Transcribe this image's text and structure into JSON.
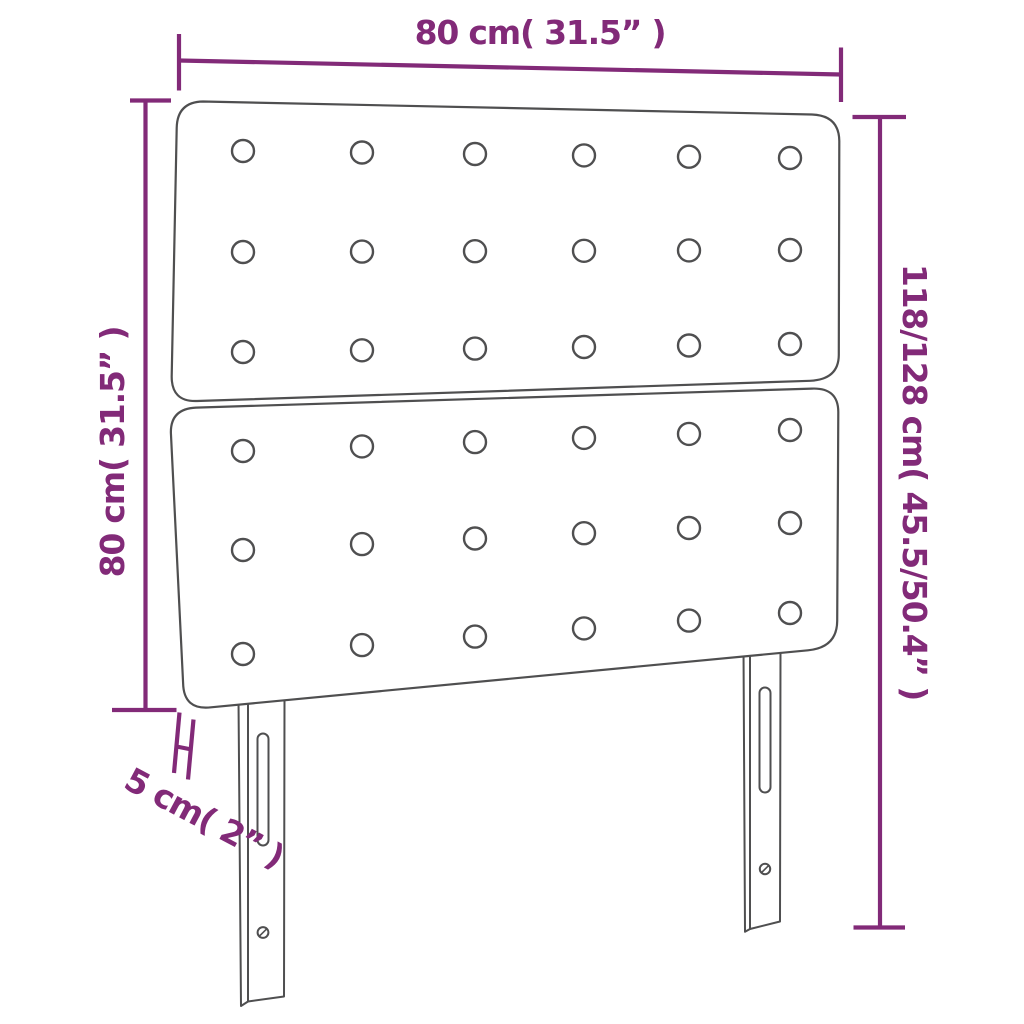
{
  "diagram": {
    "type": "product-dimension-diagram",
    "product": "upholstered-headboard-with-two-panels-and-two-legs",
    "colors": {
      "dimension_annotation": "#822a78",
      "drawing_outline": "#4f4f50",
      "background": "#ffffff"
    },
    "dimensions": {
      "width_label": "80 cm( 31.5” )",
      "height_left_label": "80 cm( 31.5” )",
      "height_right_label": "118/128 cm( 45.5/50.4” )",
      "thickness_label": "5 cm( 2” )"
    },
    "structure": {
      "panels": 2,
      "button_rows_per_panel": 3,
      "button_columns": 6,
      "legs": 2
    }
  }
}
